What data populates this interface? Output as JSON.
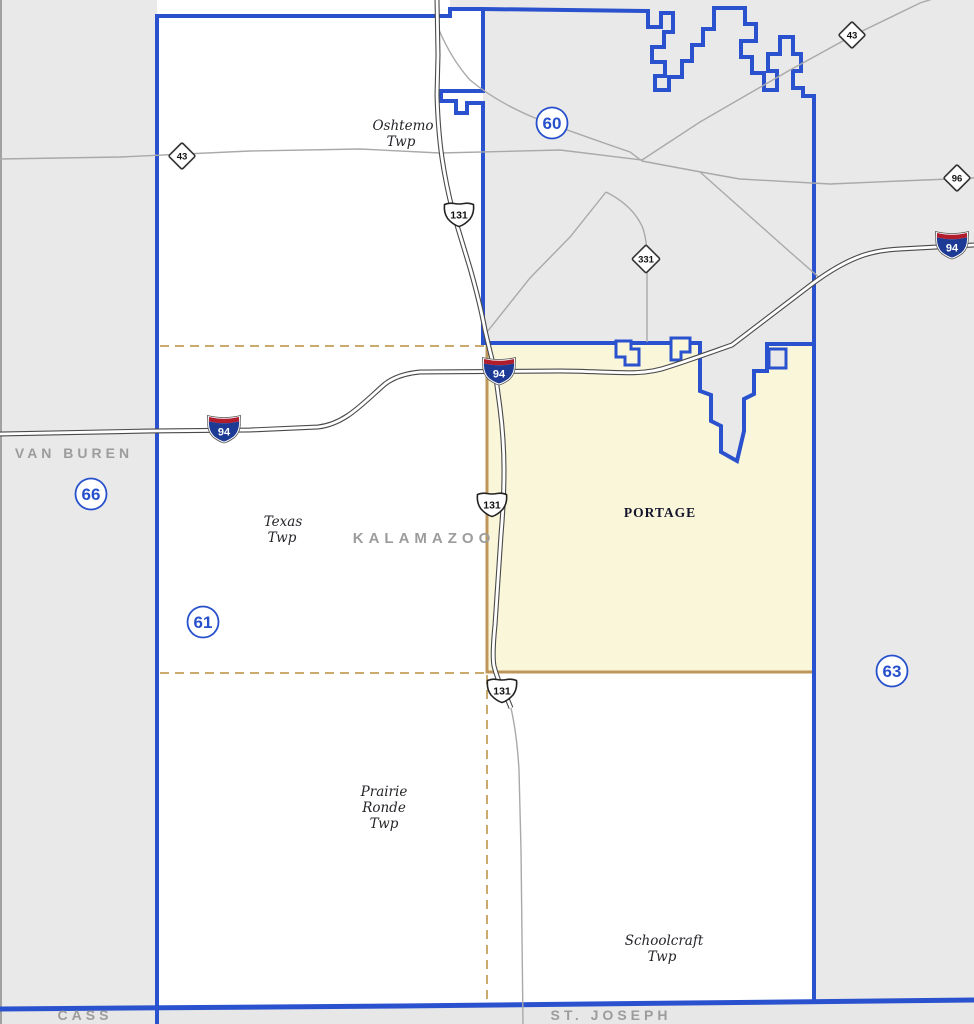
{
  "map": {
    "city_label": "PORTAGE",
    "districts": [
      {
        "number": "60"
      },
      {
        "number": "61"
      },
      {
        "number": "63"
      },
      {
        "number": "66"
      }
    ],
    "counties": [
      {
        "name": "VAN BUREN"
      },
      {
        "name": "KALAMAZOO"
      },
      {
        "name": "CASS"
      },
      {
        "name": "ST. JOSEPH"
      }
    ],
    "townships": [
      {
        "lines": [
          "Oshtemo",
          "Twp"
        ]
      },
      {
        "lines": [
          "Texas",
          "Twp"
        ]
      },
      {
        "lines": [
          "Prairie",
          "Ronde",
          "Twp"
        ]
      },
      {
        "lines": [
          "Schoolcraft",
          "Twp"
        ]
      }
    ],
    "highway_shields": {
      "interstate_94": "94",
      "us_131": "131",
      "m_43": "43",
      "m_96": "96",
      "m_331": "331"
    },
    "colors": {
      "district_boundary": "#2B52CE",
      "district_number": "#2750CC",
      "portage_fill": "#FAF6DA",
      "township_boundary": "#CBAA6E",
      "portage_border": "#BE9659",
      "map_gray": "#E9E9E9",
      "white_area": "#FFFFFF",
      "road_gray": "#A9A9A9",
      "interstate_red": "#B01E2E",
      "interstate_blue": "#1D3A94",
      "county_label_gray": "#9C9C9C"
    }
  }
}
